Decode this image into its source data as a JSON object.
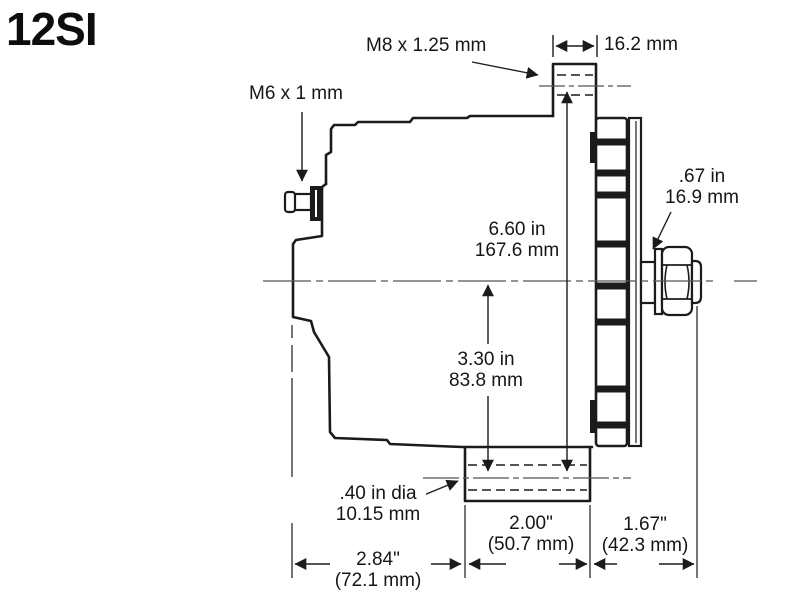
{
  "title": "12SI",
  "colors": {
    "line": "#1b1b1b",
    "text": "#161616",
    "background": "#ffffff"
  },
  "labels": {
    "m8_thread": "M8 x 1.25 mm",
    "ear_width": "16.2 mm",
    "m6_thread": "M6 x 1 mm"
  },
  "dimensions": {
    "shaft": {
      "in": ".67 in",
      "mm": "16.9 mm"
    },
    "overall_height": {
      "in": "6.60 in",
      "mm": "167.6 mm"
    },
    "center_height": {
      "in": "3.30 in",
      "mm": "83.8 mm"
    },
    "foot_hole": {
      "in": ".40 in dia",
      "mm": "10.15 mm"
    },
    "foot_length": {
      "in": "2.00\"",
      "mm": "(50.7 mm)"
    },
    "foot_to_shaft_end": {
      "in": "1.67\"",
      "mm": "(42.3 mm)"
    },
    "body_to_foot": {
      "in": "2.84\"",
      "mm": "(72.1 mm)"
    }
  }
}
